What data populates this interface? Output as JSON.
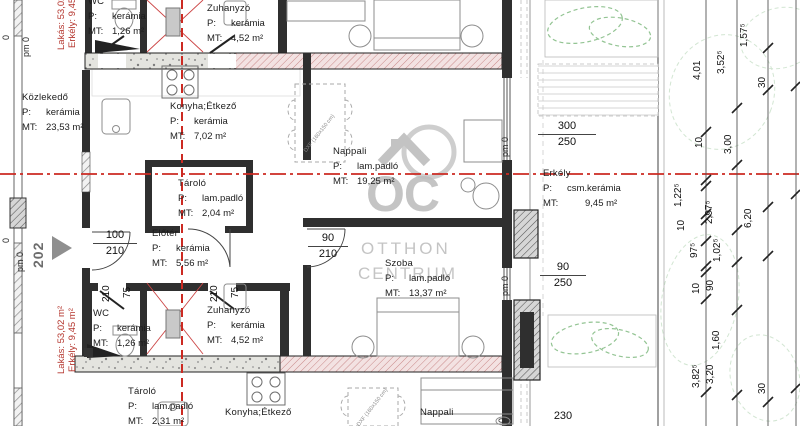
{
  "unit": {
    "number": "202",
    "area_label_1": "Lakás: 53,02 m²",
    "area_label_2": "Erkély: 9,45 m²"
  },
  "rooms": {
    "kozlekedo": {
      "name": "Közlekedő",
      "floor_label": "P:",
      "floor": "kerámia",
      "area_label": "MT:",
      "area": "23,53 m²"
    },
    "wc_top": {
      "name": "WC",
      "floor_label": "P:",
      "floor": "kerámia",
      "area_label": "MT:",
      "area": "1,26 m²"
    },
    "zuhanyzo_top": {
      "name": "Zuhanyzó",
      "floor_label": "P:",
      "floor": "kerámia",
      "area_label": "MT:",
      "area": "4,52 m²"
    },
    "konyha_top": {
      "name": "Konyha;Étkező",
      "floor_label": "P:",
      "floor": "kerámia",
      "area_label": "MT:",
      "area": "7,02 m²"
    },
    "nappali_top": {
      "name": "Nappali",
      "floor_label": "P:",
      "floor": "lam.padló",
      "area_label": "MT:",
      "area": "19,25 m²"
    },
    "tarolo_top": {
      "name": "Tároló",
      "floor_label": "P:",
      "floor": "lam.padló",
      "area_label": "MT:",
      "area": "2,04 m²"
    },
    "eloter": {
      "name": "Előtér",
      "floor_label": "P:",
      "floor": "kerámia",
      "area_label": "MT:",
      "area": "5,56 m²"
    },
    "erkely": {
      "name": "Erkély",
      "floor_label": "P:",
      "floor": "csm.kerámia",
      "area_label": "MT:",
      "area": "9,45 m²"
    },
    "szoba": {
      "name": "Szoba",
      "floor_label": "P:",
      "floor": "lam.padló",
      "area_label": "MT:",
      "area": "13,37 m²"
    },
    "wc_bottom": {
      "name": "WC",
      "floor_label": "P:",
      "floor": "kerámia",
      "area_label": "MT:",
      "area": "1,26 m²"
    },
    "zuhanyzo_bottom": {
      "name": "Zuhanyzó",
      "floor_label": "P:",
      "floor": "kerámia",
      "area_label": "MT:",
      "area": "4,52 m²"
    },
    "tarolo_bottom": {
      "name": "Tároló",
      "floor_label": "P:",
      "floor": "lam.padló",
      "area_label": "MT:",
      "area": "2,31 m²"
    },
    "konyha_bottom": {
      "name": "Konyha;Étkező"
    },
    "nappali_bottom": {
      "name": "Nappali"
    }
  },
  "openings": {
    "entry": {
      "w": "100",
      "h": "210"
    },
    "szoba_door": {
      "w": "90",
      "h": "210"
    },
    "window_large": {
      "w": "300",
      "h": "250"
    },
    "balcony_door": {
      "w": "90",
      "h": "250"
    },
    "dim_230": "230",
    "door_height": "210",
    "door_width_75": "75",
    "parapet": "pm 0",
    "zero": "0"
  },
  "dimensions": {
    "v1": "4,01",
    "v2": "3,52⁵",
    "v3": "1,57⁵",
    "v4": "30",
    "v5": "10",
    "v6": "3,00",
    "v7": "1,22⁵",
    "v8": "10",
    "v9": "97⁵",
    "v10": "10",
    "v11": "2,97⁵",
    "v12": "1,02⁵",
    "v13": "6,20",
    "v14": "90",
    "v15": "1,60",
    "v16": "3,82⁵",
    "v17": "3,20",
    "v18": "30"
  },
  "watermark": {
    "logo": "OC",
    "line1": "OTTHON",
    "line2": "CENTRUM"
  },
  "annotations": {
    "table_note": "DXF (160x150 cm)"
  },
  "colors": {
    "section_red": "#cc2a22",
    "label_red": "#b5372f",
    "wall_dark": "#2f2f2f",
    "hatch_pink": "#c98989",
    "plant_green": "#93c493",
    "watermark_gray": "#bdbdbd"
  }
}
